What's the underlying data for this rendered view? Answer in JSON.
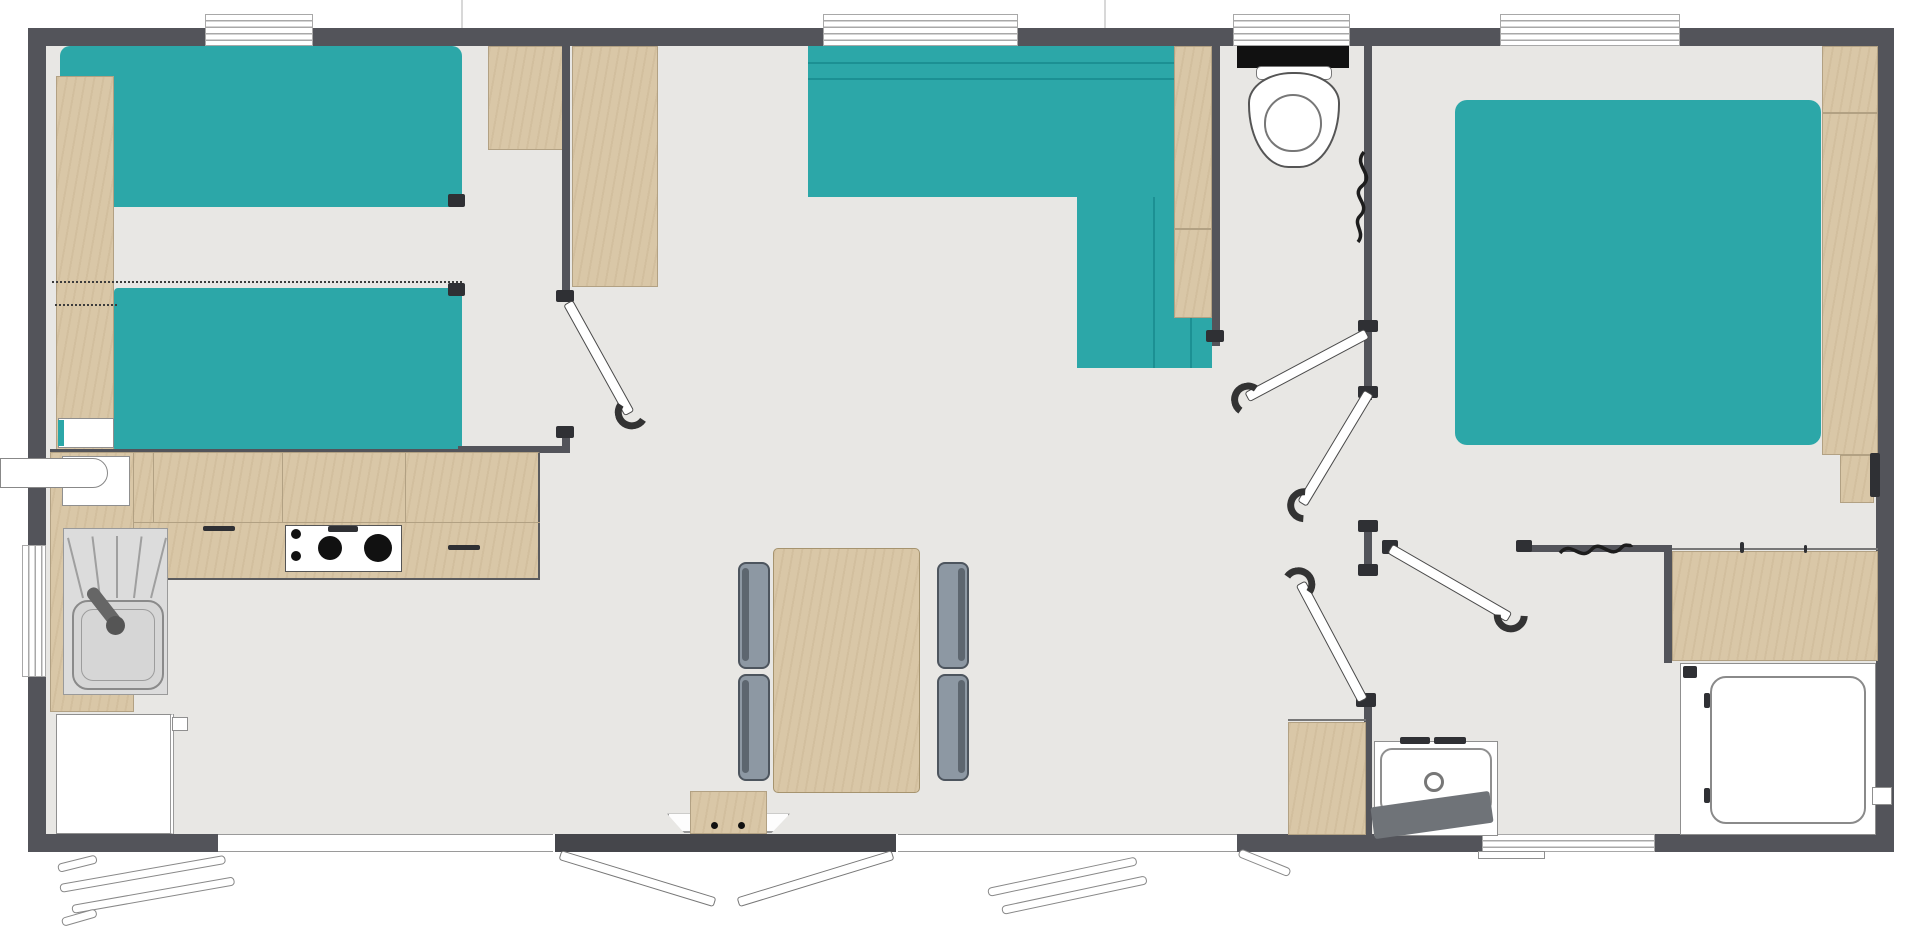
{
  "diagram": {
    "type": "floor-plan",
    "subject": "mobile-home holiday lodge, top-down architectural plan, no text labels",
    "rooms": [
      {
        "name": "twin-bedroom",
        "furniture": [
          "single-bed",
          "single-bed",
          "side-shelf",
          "wardrobe"
        ]
      },
      {
        "name": "kitchen",
        "furniture": [
          "l-shaped-counter",
          "gas-hob-2-burners",
          "sink-with-drainer",
          "boiler",
          "fridge"
        ]
      },
      {
        "name": "dining-area",
        "furniture": [
          "dining-table",
          "chair",
          "chair",
          "chair",
          "chair",
          "entrance-step"
        ]
      },
      {
        "name": "living-area",
        "furniture": [
          "corner-sofa",
          "storage-column"
        ]
      },
      {
        "name": "wc",
        "furniture": [
          "toilet",
          "cistern"
        ]
      },
      {
        "name": "hallway",
        "furniture": []
      },
      {
        "name": "master-bedroom",
        "furniture": [
          "double-bed",
          "wardrobe",
          "bedside-unit"
        ]
      },
      {
        "name": "shower-room",
        "furniture": [
          "washbasin-unit",
          "vanity-cabinet",
          "bath-mat",
          "dresser-counter",
          "shower-cubicle"
        ]
      }
    ],
    "doors": [
      "twin-bedroom-door",
      "wc-door",
      "master-bedroom-door",
      "shower-room-door",
      "hallway-door",
      "entrance-double-door"
    ],
    "window_count": 8,
    "exterior_elements": [
      "entrance-step",
      "open-shutter-left",
      "open-shutter-right",
      "entrance-door-leaves"
    ]
  },
  "palette": {
    "wall": "#53545a",
    "floor": "#e8e7e4",
    "teal": "#2ca7a8",
    "teal-line": "#117e82",
    "wood": "#d9c7a7",
    "wood-line": "#b2a183",
    "chair": "#8d98a3",
    "chair-line": "#4d555e",
    "fixture-line": "#8f8f8f",
    "dark": "#2f3034",
    "mat": "#6f7378",
    "window-line": "#a8a8a8"
  }
}
